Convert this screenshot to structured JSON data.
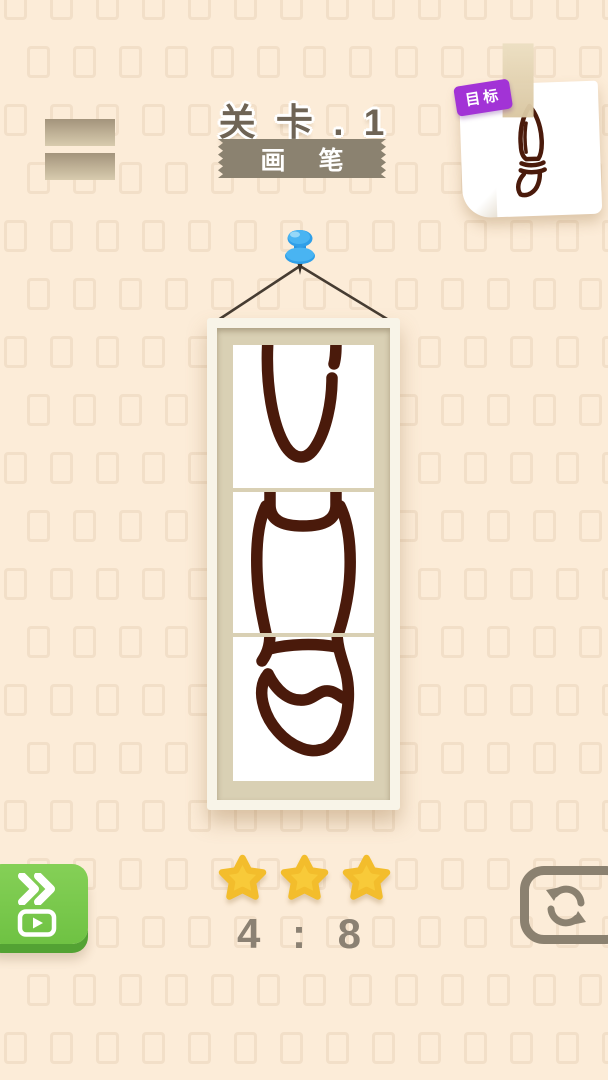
{
  "header": {
    "level_label": "关 卡 . 1",
    "ribbon_label": "画 笔"
  },
  "target": {
    "tag_label": "目标"
  },
  "footer": {
    "score": "4 : 8",
    "stars_count": 3
  },
  "icons": {
    "menu": "menu-bars",
    "pin": "blue-pushpin",
    "skip": "fast-forward-chevrons",
    "video": "play-video",
    "restart": "refresh-arrows",
    "star": "gold-star"
  },
  "colors": {
    "background": "#fcecd8",
    "drawing_stroke": "#4a1a0b",
    "frame_mat": "#d9d0b4",
    "ribbon_gray": "#8b8270",
    "accent_green": "#76c74a",
    "accent_purple": "#a233d6",
    "pin_blue": "#2f9fe8",
    "star_gold": "#f8ca39",
    "ui_gray": "#8b8170"
  }
}
